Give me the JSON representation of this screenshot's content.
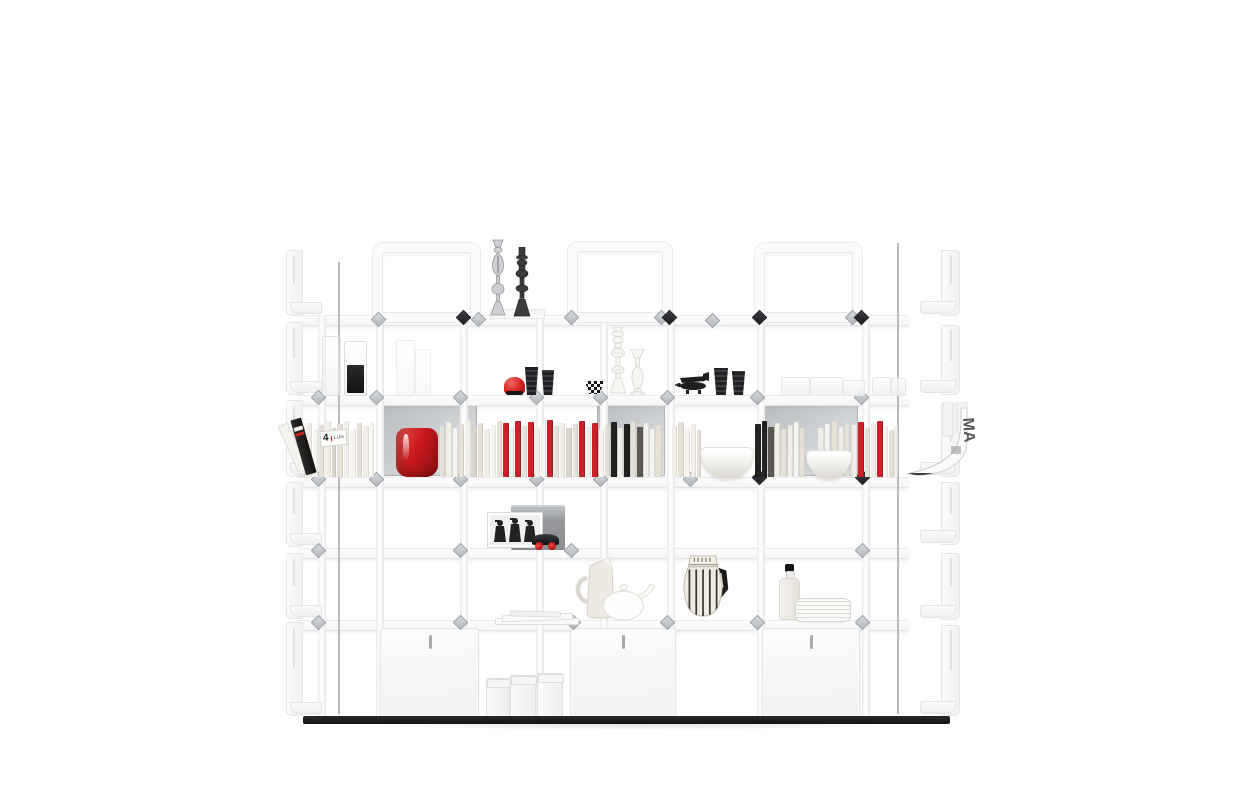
{
  "meta": {
    "description": "Product photograph of a white modular shelving wall unit styled with books and objects on a white background"
  },
  "palette": {
    "background": "#ffffff",
    "structure_white": "#fbfbfb",
    "structure_edge": "#e9e9ea",
    "back_panel_gray": "#c6c9cc",
    "silver_clip": "#c2c7cc",
    "dark_clip": "#2a2a30",
    "accent_red": "#cd2127",
    "object_black": "#1c1c1e",
    "cream": "#eae7e0",
    "plinth_black": "#161618"
  },
  "text": {
    "calendar_day": "4",
    "calendar_month_label": "LUN",
    "magazine_letters": "MA"
  },
  "structure": {
    "shelves": {
      "x": 298,
      "w": 610,
      "h": 9,
      "ys": [
        315,
        395,
        477,
        548,
        620
      ]
    },
    "posts": {
      "w": 6,
      "y": 315,
      "h": 401,
      "xs": [
        318,
        376,
        460,
        536,
        600,
        667,
        757,
        862
      ]
    },
    "rods": [
      {
        "x": 338,
        "y": 262,
        "h": 452
      },
      {
        "x": 897,
        "y": 243,
        "h": 471
      }
    ],
    "top_frames": [
      {
        "x": 373,
        "y": 243,
        "w": 107,
        "h": 79
      },
      {
        "x": 568,
        "y": 242,
        "w": 104,
        "h": 80
      },
      {
        "x": 755,
        "y": 243,
        "w": 107,
        "h": 79
      }
    ],
    "gray_backs": [
      {
        "x": 382,
        "y": 399,
        "w": 95,
        "h": 77
      },
      {
        "x": 597,
        "y": 399,
        "w": 68,
        "h": 77
      },
      {
        "x": 762,
        "y": 399,
        "w": 96,
        "h": 77
      }
    ],
    "left_panels": {
      "x": 286,
      "w": 34,
      "rows": [
        {
          "y": 250,
          "h": 64
        },
        {
          "y": 322,
          "h": 71
        },
        {
          "y": 400,
          "h": 75
        },
        {
          "y": 482,
          "h": 63
        },
        {
          "y": 553,
          "h": 64
        },
        {
          "y": 622,
          "h": 92
        }
      ]
    },
    "right_panels": {
      "x": 922,
      "w": 38,
      "rows": [
        {
          "y": 250,
          "h": 64
        },
        {
          "y": 325,
          "h": 68
        },
        {
          "y": 404,
          "h": 71
        },
        {
          "y": 482,
          "h": 61
        },
        {
          "y": 553,
          "h": 65
        },
        {
          "y": 625,
          "h": 89
        }
      ]
    },
    "cabinets": {
      "y": 628,
      "h": 88,
      "items": [
        {
          "x": 380,
          "w": 97
        },
        {
          "x": 570,
          "w": 104
        },
        {
          "x": 762,
          "w": 96
        }
      ]
    },
    "clips": {
      "dark": [
        [
          463,
          317
        ],
        [
          669,
          317
        ],
        [
          759,
          317
        ],
        [
          861,
          317
        ],
        [
          759,
          477
        ],
        [
          862,
          477
        ]
      ],
      "silver": [
        [
          378,
          319
        ],
        [
          478,
          319
        ],
        [
          571,
          317
        ],
        [
          661,
          317
        ],
        [
          712,
          320
        ],
        [
          852,
          317
        ],
        [
          318,
          397
        ],
        [
          376,
          397
        ],
        [
          460,
          397
        ],
        [
          536,
          397
        ],
        [
          600,
          397
        ],
        [
          667,
          397
        ],
        [
          757,
          397
        ],
        [
          861,
          397
        ],
        [
          318,
          479
        ],
        [
          376,
          479
        ],
        [
          460,
          479
        ],
        [
          536,
          479
        ],
        [
          600,
          479
        ],
        [
          690,
          479
        ],
        [
          318,
          550
        ],
        [
          460,
          550
        ],
        [
          571,
          550
        ],
        [
          862,
          550
        ],
        [
          318,
          622
        ],
        [
          460,
          622
        ],
        [
          573,
          622
        ],
        [
          667,
          622
        ],
        [
          757,
          622
        ],
        [
          862,
          622
        ]
      ]
    },
    "base": {
      "x": 303,
      "y": 716,
      "w": 647,
      "h": 8
    },
    "floor_shadow": {
      "x": 310,
      "y": 724,
      "w": 640,
      "h": 9
    }
  },
  "books": {
    "base_y": 477,
    "colors": {
      "w1": "#f1eee7",
      "w2": "#e5e1d7",
      "w3": "#f6f4ef",
      "w4": "#d9d5c9",
      "r": "#cd2127",
      "k": "#24221f",
      "dk": "#5c5953"
    },
    "spines": [
      [
        300,
        5,
        50,
        "w2"
      ],
      [
        306,
        6,
        54,
        "w1"
      ],
      [
        313,
        5,
        48,
        "w3"
      ],
      [
        319,
        5,
        52,
        "w2"
      ],
      [
        325,
        6,
        56,
        "w1"
      ],
      [
        332,
        4,
        49,
        "w4"
      ],
      [
        337,
        6,
        53,
        "w2"
      ],
      [
        344,
        5,
        56,
        "w1"
      ],
      [
        350,
        6,
        48,
        "w3"
      ],
      [
        357,
        5,
        54,
        "w2"
      ],
      [
        363,
        6,
        51,
        "w1"
      ],
      [
        370,
        4,
        55,
        "w3"
      ],
      [
        440,
        5,
        51,
        "w2"
      ],
      [
        446,
        6,
        55,
        "w1"
      ],
      [
        453,
        5,
        49,
        "w3"
      ],
      [
        459,
        5,
        53,
        "w2"
      ],
      [
        465,
        6,
        57,
        "w1"
      ],
      [
        472,
        5,
        50,
        "w4"
      ],
      [
        478,
        5,
        54,
        "w2"
      ],
      [
        484,
        6,
        48,
        "w1"
      ],
      [
        491,
        5,
        52,
        "w3"
      ],
      [
        497,
        5,
        56,
        "w2"
      ],
      [
        503,
        6,
        54,
        "r"
      ],
      [
        510,
        4,
        49,
        "w1"
      ],
      [
        515,
        6,
        56,
        "r"
      ],
      [
        522,
        5,
        51,
        "w2"
      ],
      [
        528,
        6,
        55,
        "r"
      ],
      [
        535,
        5,
        49,
        "w1"
      ],
      [
        541,
        5,
        53,
        "w3"
      ],
      [
        547,
        6,
        57,
        "r"
      ],
      [
        554,
        5,
        51,
        "w2"
      ],
      [
        560,
        5,
        54,
        "w1"
      ],
      [
        566,
        6,
        49,
        "w4"
      ],
      [
        573,
        5,
        53,
        "w2"
      ],
      [
        579,
        6,
        56,
        "r"
      ],
      [
        586,
        5,
        50,
        "w1"
      ],
      [
        592,
        6,
        54,
        "r"
      ],
      [
        599,
        5,
        48,
        "w3"
      ],
      [
        605,
        5,
        52,
        "w2"
      ],
      [
        611,
        6,
        55,
        "k"
      ],
      [
        618,
        5,
        49,
        "w1"
      ],
      [
        624,
        6,
        53,
        "k"
      ],
      [
        631,
        5,
        56,
        "w2"
      ],
      [
        637,
        6,
        50,
        "dk"
      ],
      [
        644,
        5,
        54,
        "w1"
      ],
      [
        650,
        5,
        48,
        "w3"
      ],
      [
        656,
        6,
        52,
        "w2"
      ],
      [
        672,
        5,
        51,
        "w1"
      ],
      [
        678,
        6,
        55,
        "w2"
      ],
      [
        685,
        5,
        49,
        "w3"
      ],
      [
        691,
        5,
        53,
        "w1"
      ],
      [
        697,
        4,
        47,
        "w2"
      ],
      [
        755,
        6,
        53,
        "k"
      ],
      [
        762,
        5,
        56,
        "k"
      ],
      [
        768,
        6,
        50,
        "dk"
      ],
      [
        775,
        5,
        54,
        "w1"
      ],
      [
        781,
        6,
        48,
        "w2"
      ],
      [
        788,
        5,
        52,
        "w1"
      ],
      [
        794,
        5,
        55,
        "w3"
      ],
      [
        800,
        5,
        49,
        "w2"
      ],
      [
        818,
        6,
        49,
        "w1"
      ],
      [
        825,
        5,
        53,
        "w3"
      ],
      [
        832,
        6,
        56,
        "w2"
      ],
      [
        839,
        5,
        50,
        "w1"
      ],
      [
        845,
        5,
        54,
        "w2"
      ],
      [
        852,
        5,
        52,
        "w1"
      ],
      [
        858,
        6,
        55,
        "r"
      ],
      [
        865,
        5,
        49,
        "w2"
      ],
      [
        871,
        5,
        53,
        "w1"
      ],
      [
        877,
        6,
        56,
        "r"
      ],
      [
        884,
        4,
        50,
        "w3"
      ],
      [
        889,
        5,
        47,
        "w2"
      ],
      [
        894,
        4,
        51,
        "w1"
      ]
    ]
  },
  "objects": [
    {
      "type": "whiteblock",
      "name": "candlestick-base-block",
      "x": 489,
      "y": 309,
      "w": 54,
      "h": 8
    },
    {
      "type": "svg-silver-candlestick",
      "name": "candlestick-silver",
      "x": 486,
      "y": 238,
      "w": 24,
      "h": 80
    },
    {
      "type": "svg-black-candlestick",
      "name": "candlestick-black",
      "x": 510,
      "y": 247,
      "w": 24,
      "h": 71
    },
    {
      "type": "beaker",
      "name": "glass-beaker",
      "x": 322,
      "y": 336,
      "w": 17,
      "h": 58,
      "op": 0.85
    },
    {
      "type": "glassblack",
      "name": "glass-with-black-liquid",
      "x": 344,
      "y": 341,
      "w": 21,
      "h": 53
    },
    {
      "type": "beaker",
      "name": "glass-beaker",
      "x": 396,
      "y": 340,
      "w": 17,
      "h": 54,
      "op": 0.55
    },
    {
      "type": "beaker",
      "name": "glass-beaker",
      "x": 415,
      "y": 349,
      "w": 14,
      "h": 45,
      "op": 0.5
    },
    {
      "type": "cup",
      "name": "black-cup",
      "x": 524,
      "y": 367,
      "w": 15,
      "h": 28
    },
    {
      "type": "cup",
      "name": "black-cup",
      "x": 541,
      "y": 370,
      "w": 14,
      "h": 25
    },
    {
      "type": "redtoy",
      "name": "red-toy",
      "x": 504,
      "y": 377,
      "w": 21,
      "h": 18
    },
    {
      "type": "checkerbowl",
      "name": "checkered-bowl",
      "x": 585,
      "y": 381,
      "w": 19,
      "h": 13
    },
    {
      "type": "svg-white-candlestick",
      "name": "candlestick-white",
      "x": 606,
      "y": 327,
      "w": 24,
      "h": 68
    },
    {
      "type": "svg-bud-vase",
      "name": "white-bud-vase",
      "x": 628,
      "y": 349,
      "w": 19,
      "h": 46
    },
    {
      "type": "svg-airplane",
      "name": "toy-airplane",
      "x": 674,
      "y": 371,
      "w": 38,
      "h": 24
    },
    {
      "type": "cup",
      "name": "black-cup",
      "x": 713,
      "y": 368,
      "w": 16,
      "h": 27
    },
    {
      "type": "cup",
      "name": "black-cup",
      "x": 731,
      "y": 371,
      "w": 15,
      "h": 24
    },
    {
      "type": "tray",
      "name": "glass-tray",
      "x": 781,
      "y": 377,
      "w": 27,
      "h": 17
    },
    {
      "type": "tray",
      "name": "glass-tray",
      "x": 810,
      "y": 377,
      "w": 31,
      "h": 17
    },
    {
      "type": "tray",
      "name": "glass-tray",
      "x": 843,
      "y": 380,
      "w": 20,
      "h": 14
    },
    {
      "type": "tray",
      "name": "glass-tray",
      "x": 872,
      "y": 377,
      "w": 17,
      "h": 17
    },
    {
      "type": "tray",
      "name": "glass-tray",
      "x": 891,
      "y": 378,
      "w": 13,
      "h": 16
    },
    {
      "type": "leaningbook",
      "name": "leaning-book",
      "x": 286,
      "y": 416,
      "w": 34,
      "h": 61
    },
    {
      "type": "redvase",
      "name": "red-vase",
      "x": 396,
      "y": 428,
      "w": 42,
      "h": 49
    },
    {
      "type": "bowl",
      "name": "white-bowl",
      "x": 700,
      "y": 447,
      "w": 52,
      "h": 30
    },
    {
      "type": "bowl",
      "name": "white-bowl",
      "x": 806,
      "y": 450,
      "w": 44,
      "h": 27
    },
    {
      "type": "graybox",
      "name": "gray-box",
      "x": 511,
      "y": 505,
      "w": 54,
      "h": 43
    },
    {
      "type": "svg-photo",
      "name": "photo-frame",
      "x": 487,
      "y": 512,
      "w": 56,
      "h": 36
    },
    {
      "type": "toycar",
      "name": "toy-car",
      "x": 532,
      "y": 534,
      "w": 27,
      "h": 16
    },
    {
      "type": "notebook",
      "name": "notebook-stack",
      "x": 495,
      "y": 611,
      "w": 82,
      "h": 14
    },
    {
      "type": "svg-jug",
      "name": "cream-jug",
      "x": 573,
      "y": 556,
      "w": 48,
      "h": 64
    },
    {
      "type": "svg-teapot",
      "name": "white-teapot",
      "x": 596,
      "y": 580,
      "w": 64,
      "h": 42
    },
    {
      "type": "svg-pitcher",
      "name": "striped-pitcher",
      "x": 675,
      "y": 554,
      "w": 58,
      "h": 66
    },
    {
      "type": "bottle",
      "name": "white-bottle",
      "x": 779,
      "y": 564,
      "w": 21,
      "h": 56
    },
    {
      "type": "plates",
      "name": "plate-stack",
      "x": 795,
      "y": 598,
      "w": 54,
      "h": 22
    },
    {
      "type": "canister",
      "name": "white-canister",
      "x": 486,
      "y": 678,
      "w": 22,
      "h": 38
    },
    {
      "type": "canister",
      "name": "white-canister",
      "x": 510,
      "y": 675,
      "w": 24,
      "h": 41
    },
    {
      "type": "canister",
      "name": "white-canister",
      "x": 537,
      "y": 673,
      "w": 24,
      "h": 43
    }
  ]
}
